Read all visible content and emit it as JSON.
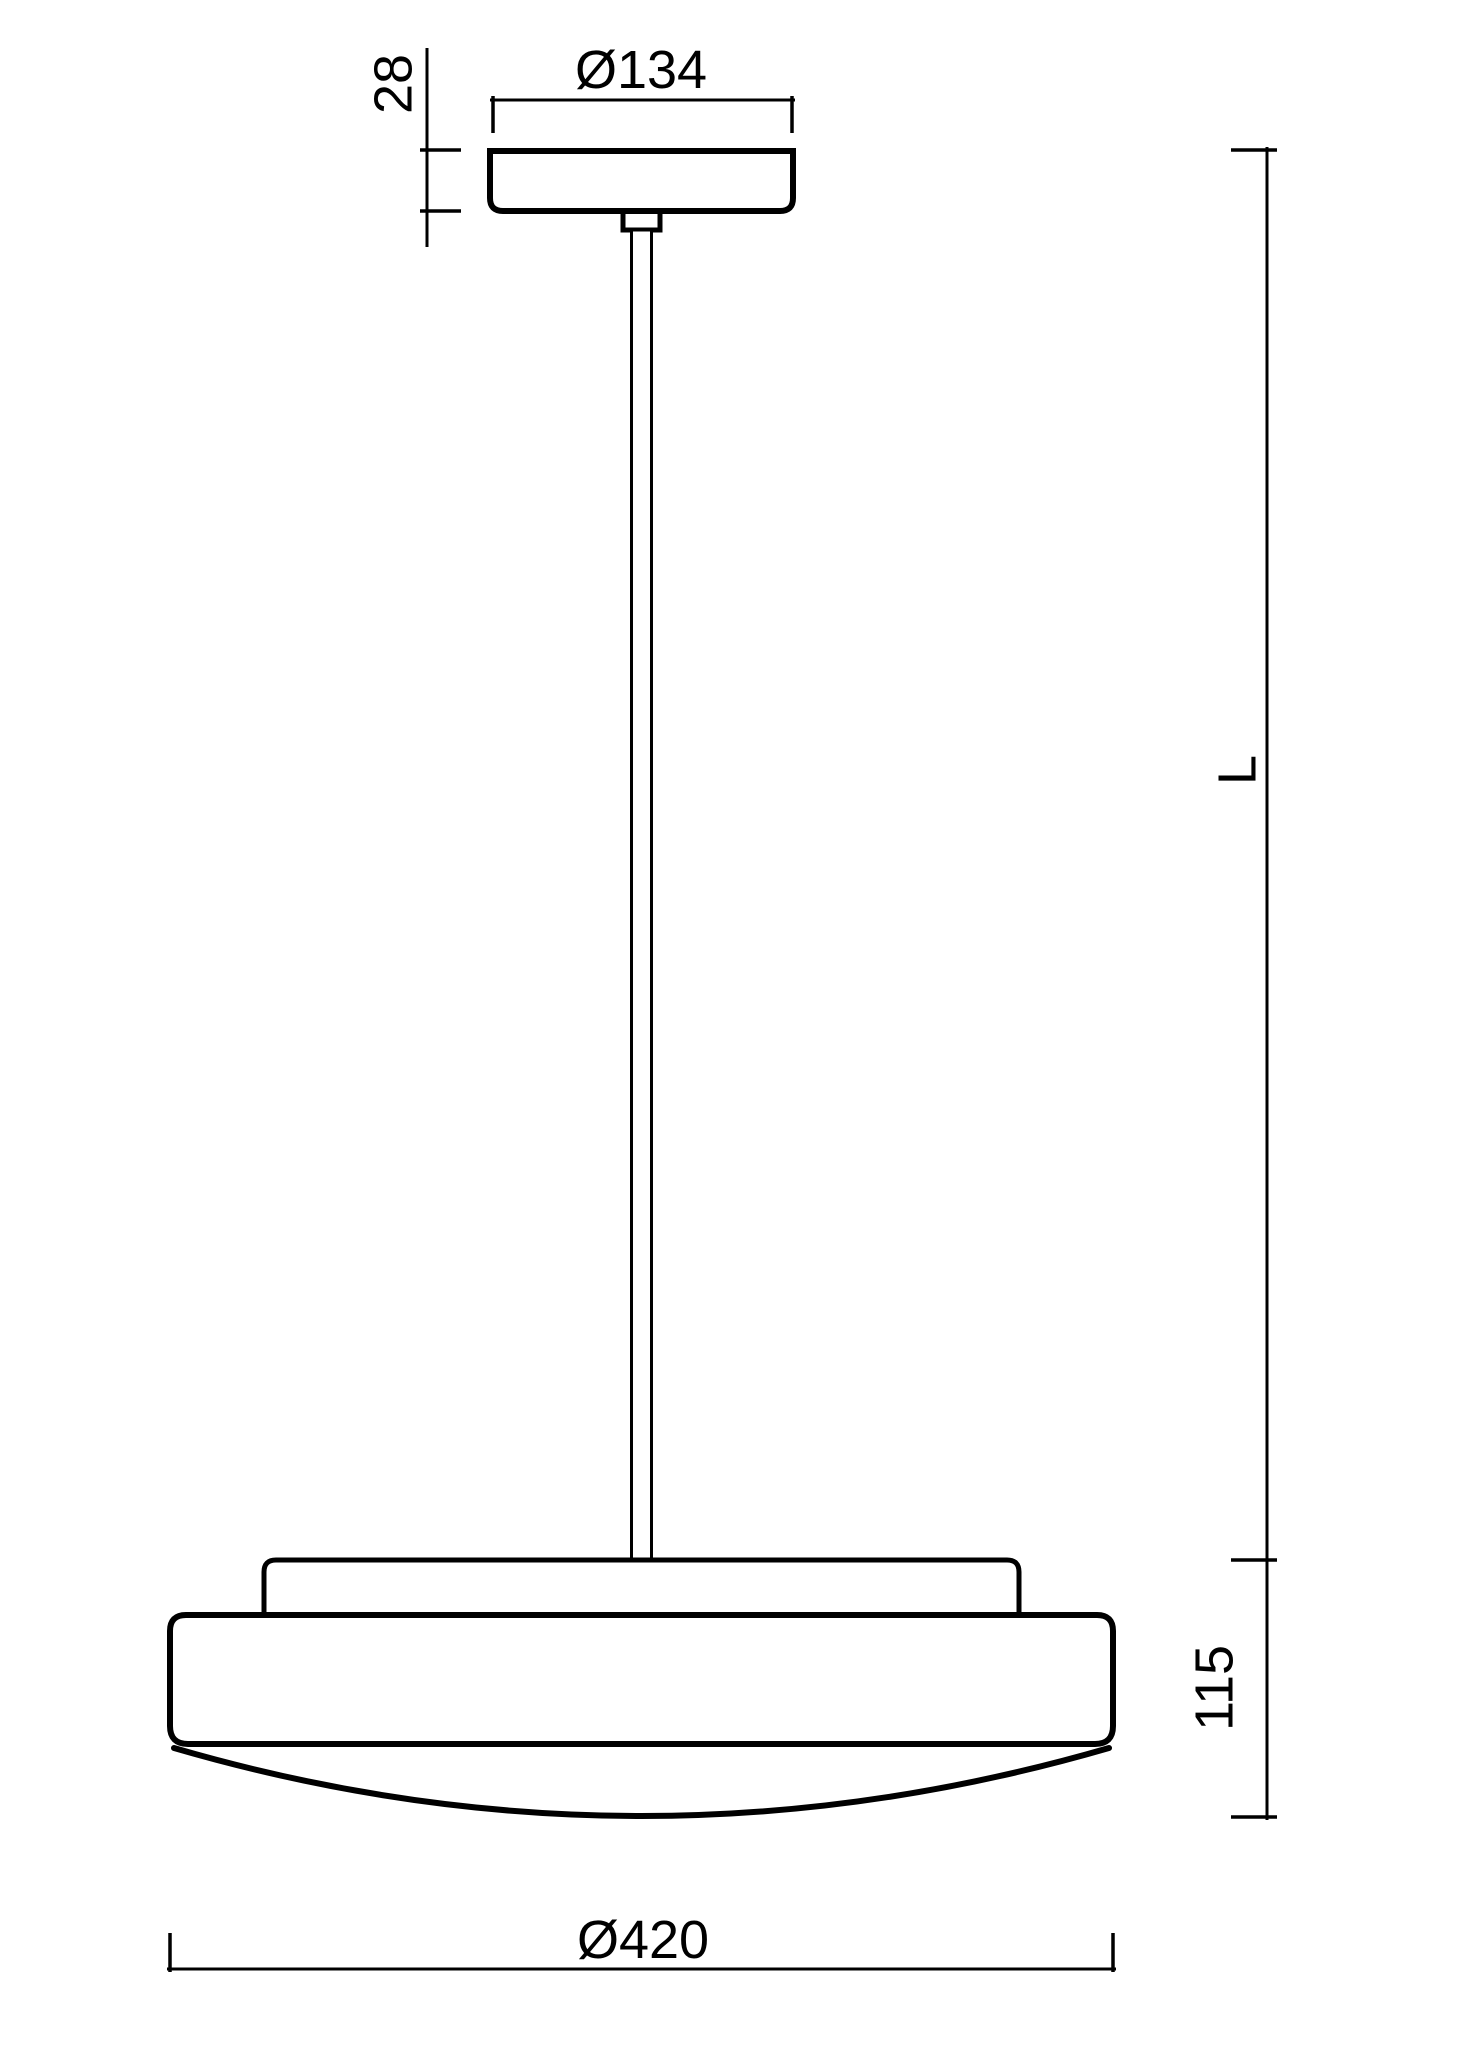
{
  "page": {
    "background_color": "#ffffff",
    "line_color": "#000000"
  },
  "drawing": {
    "kind": "technical-dimension-drawing",
    "subject": "pendant-luminaire-side-view",
    "parts": [
      "ceiling-canopy",
      "stem-connector",
      "suspension-stem",
      "shade-mounting-plate",
      "shade-body",
      "shade-glass-bottom"
    ]
  },
  "dimensions": {
    "canopy_height": {
      "label": "28"
    },
    "canopy_diameter": {
      "label": "Ø134"
    },
    "pendant_length": {
      "label": "L"
    },
    "shade_height": {
      "label": "115"
    },
    "shade_diameter": {
      "label": "Ø420"
    }
  }
}
